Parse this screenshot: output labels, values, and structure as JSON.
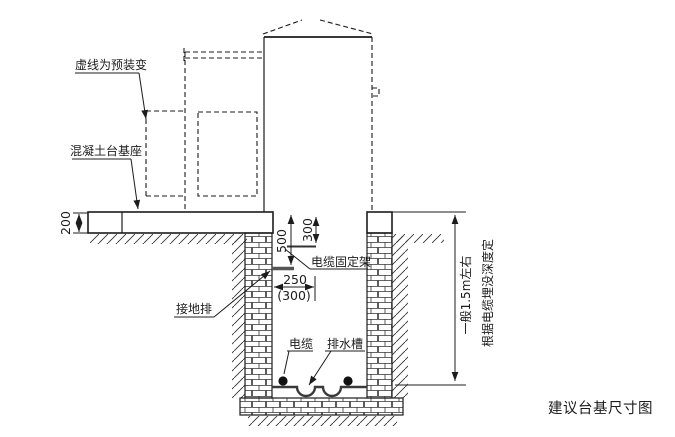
{
  "figure": {
    "title": "建议台基尺寸图",
    "callouts": {
      "dashed_note": "虚线为预装变",
      "concrete_base": "混凝土台基座",
      "ground_bar": "接地排",
      "cable_bracket": "电缆固定架",
      "cable": "电缆",
      "drain": "排水槽"
    },
    "dims": {
      "slab_thickness": "200",
      "bar_depth": "500",
      "bracket_depth": "300",
      "bracket_len": "250",
      "bracket_len_alt": "(300)",
      "depth_note_1": "一般1.5m左右",
      "depth_note_2": "根据电缆埋没深度定"
    },
    "colors": {
      "line": "#1c1c1c",
      "background": "#ffffff"
    }
  }
}
